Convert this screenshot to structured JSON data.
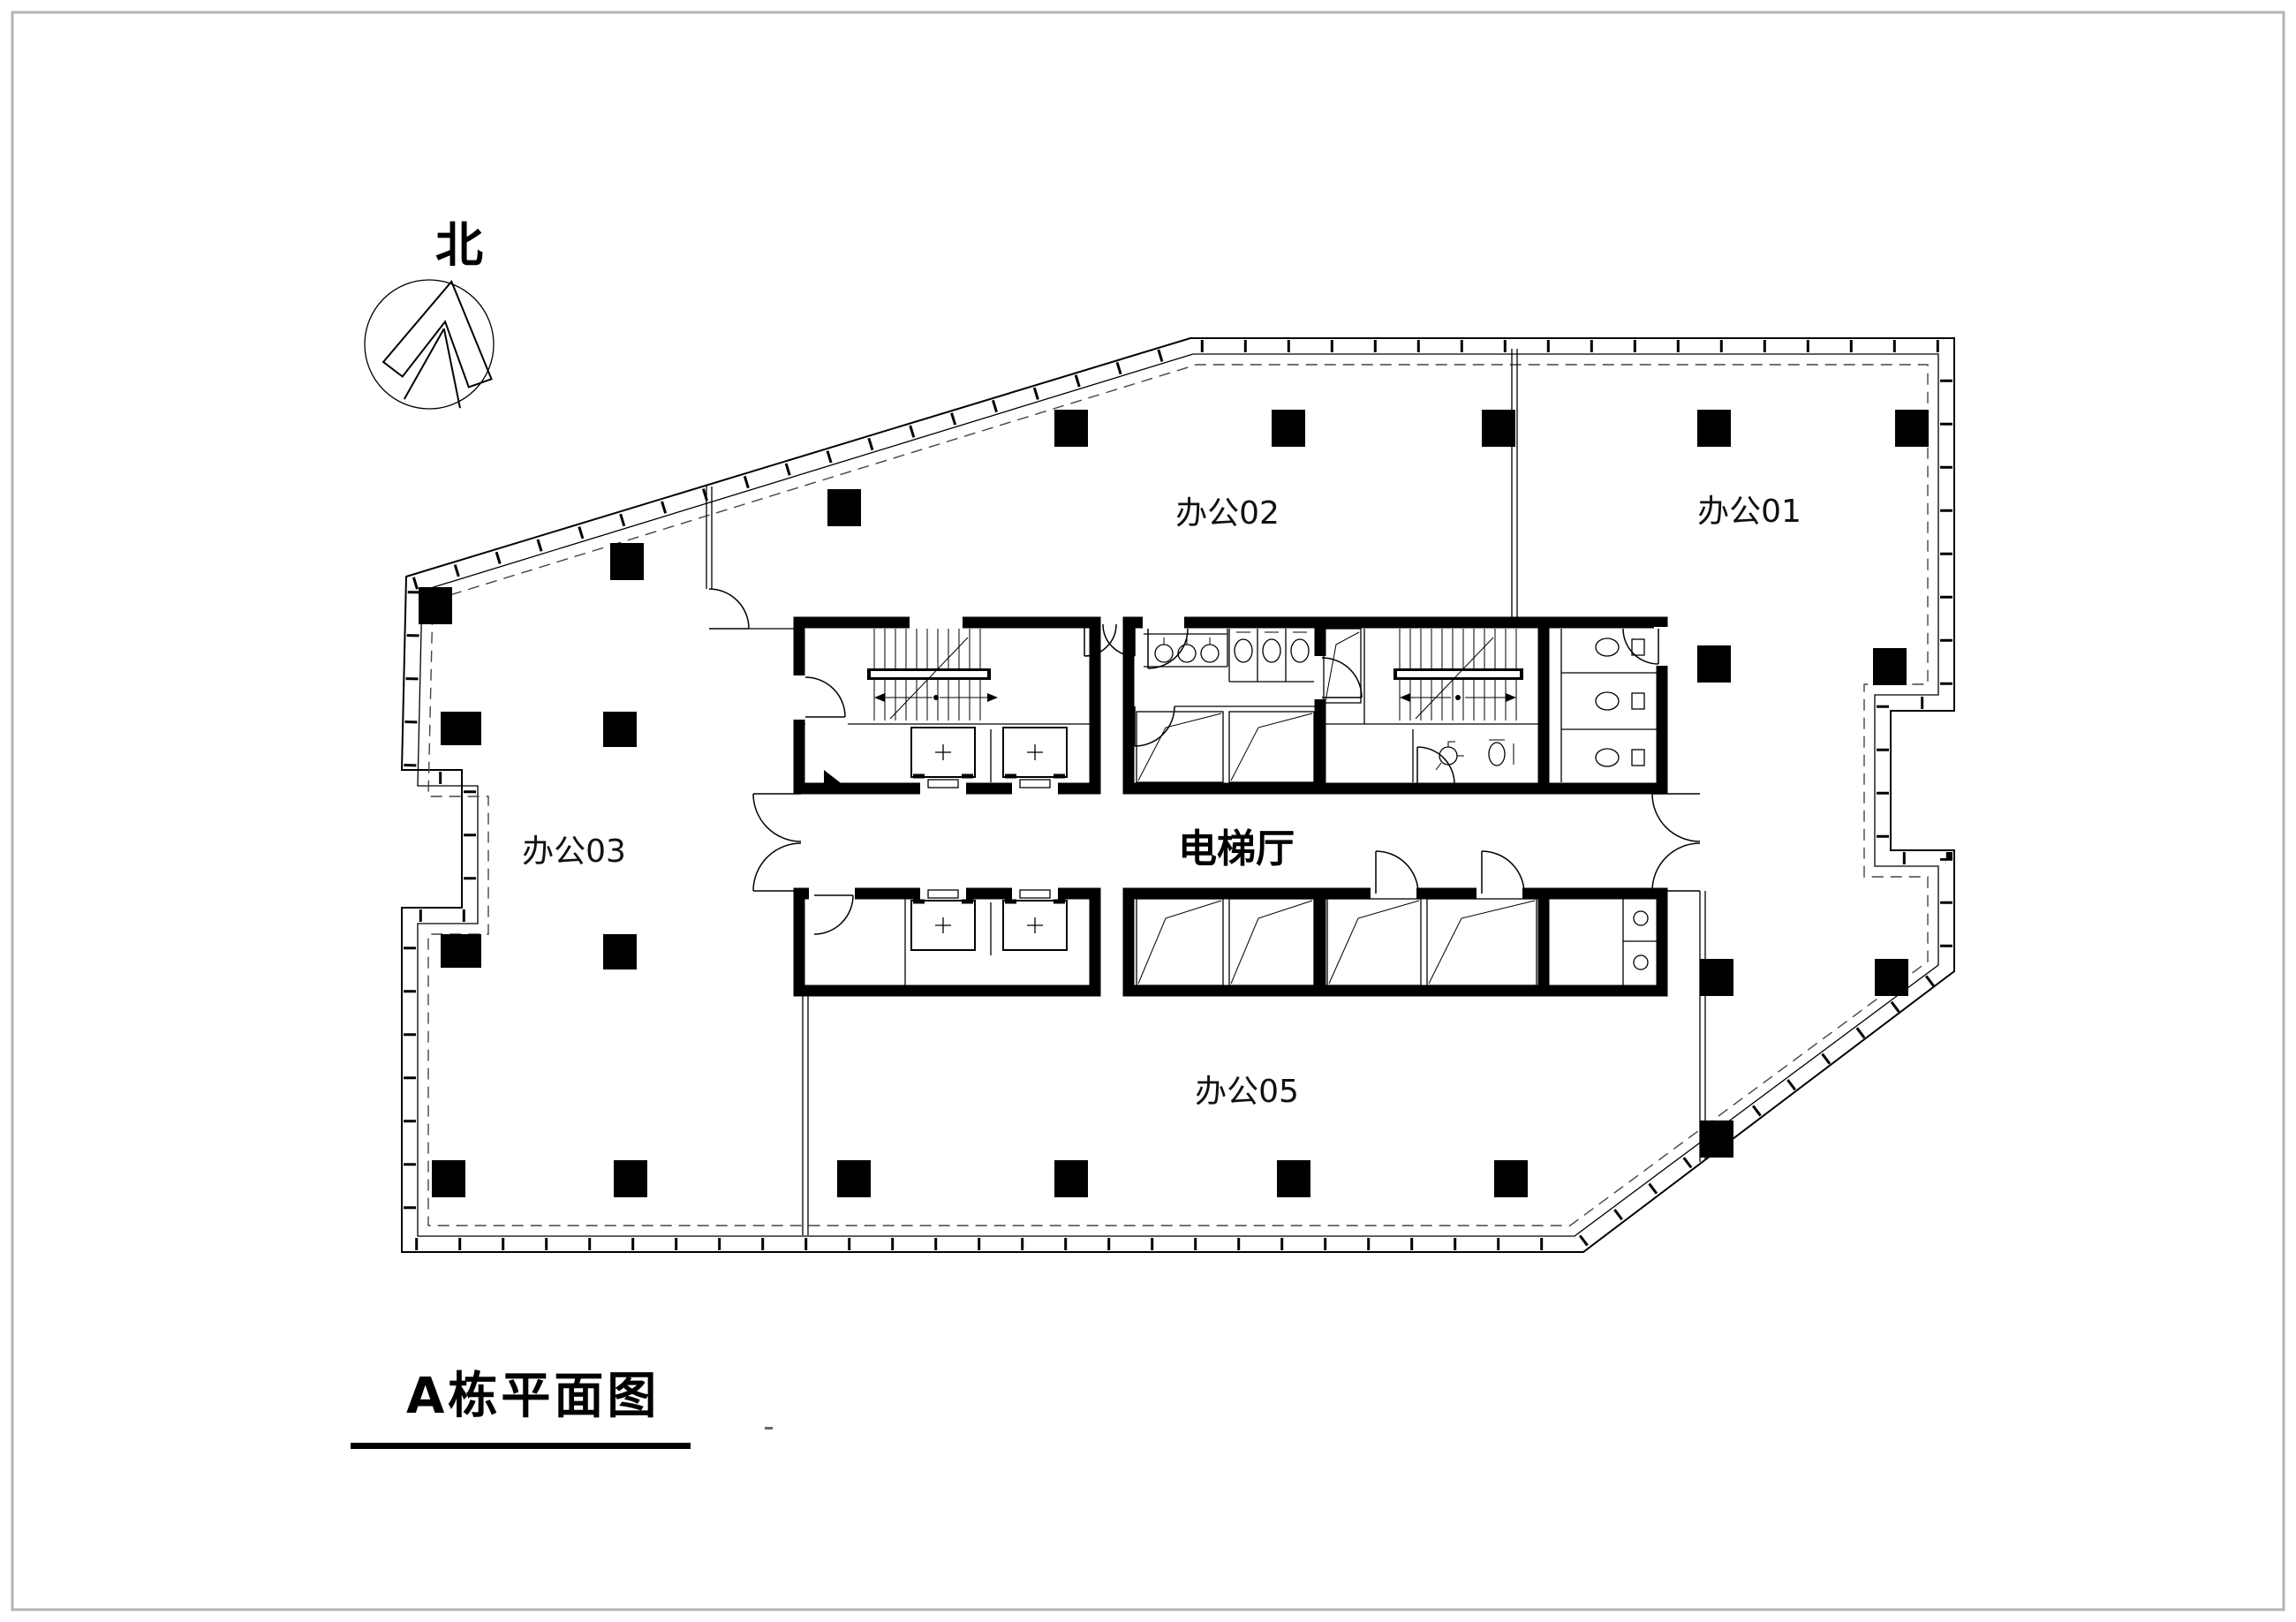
{
  "drawing": {
    "title": "A栋平面图",
    "north_label": "北",
    "rooms": [
      {
        "id": "office02",
        "label": "办公02"
      },
      {
        "id": "office01",
        "label": "办公01"
      },
      {
        "id": "office03",
        "label": "办公03"
      },
      {
        "id": "office05",
        "label": "办公05"
      },
      {
        "id": "elevator_hall",
        "label": "电梯厅"
      }
    ],
    "colors": {
      "ink": "#000000",
      "paper": "#ffffff",
      "frame": "#b5b5b5"
    }
  }
}
